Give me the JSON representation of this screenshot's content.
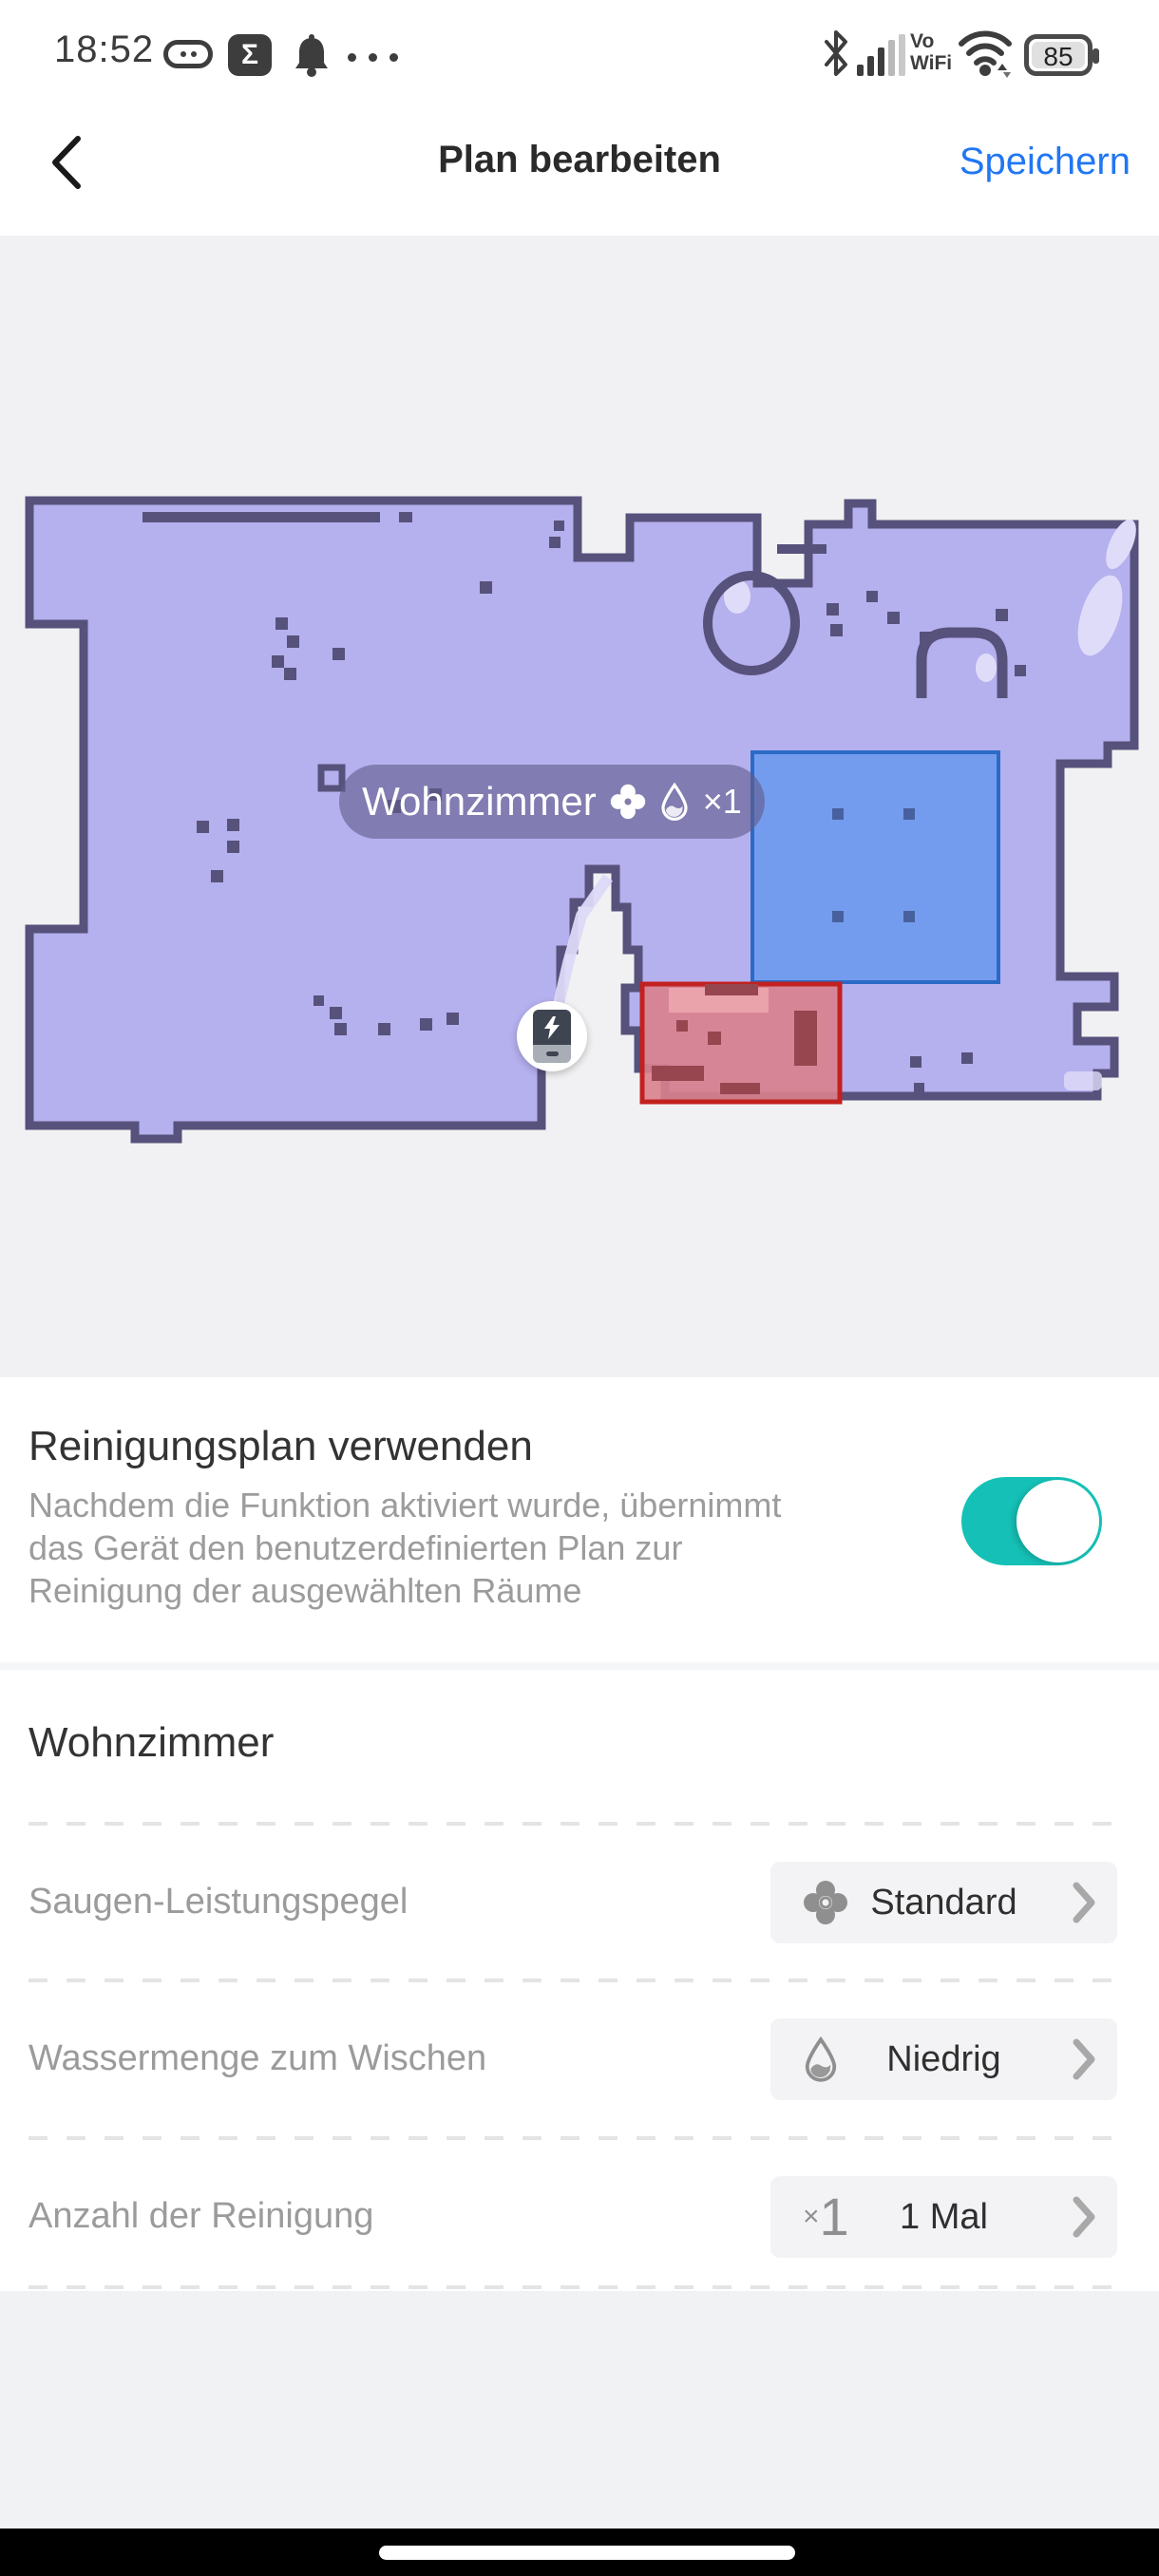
{
  "status_bar": {
    "time": "18:52",
    "sigma_glyph": "Σ",
    "vo_line1": "Vo",
    "vo_line2": "WiFi",
    "battery_percent": "85"
  },
  "header": {
    "title": "Plan bearbeiten",
    "save_label": "Speichern"
  },
  "map": {
    "pill": {
      "room_name": "Wohnzimmer",
      "count": "×1"
    }
  },
  "toggle_section": {
    "title": "Reinigungsplan verwenden",
    "description": "Nachdem die Funktion aktiviert wurde, übernimmt das Gerät den benutzerdefinierten Plan zur Reinigung der ausgewählten Räume",
    "state": "on"
  },
  "room_section": {
    "title": "Wohnzimmer",
    "rows": [
      {
        "label": "Saugen-Leistungspegel",
        "value": "Standard",
        "icon": "fan-icon"
      },
      {
        "label": "Wassermenge zum Wischen",
        "value": "Niedrig",
        "icon": "water-drop-icon"
      },
      {
        "label": "Anzahl der Reinigung",
        "value": "1 Mal",
        "icon": "times-one-icon",
        "icon_x": "×",
        "icon_num": "1"
      }
    ]
  },
  "colors": {
    "accent_blue": "#2176f3",
    "toggle_on_teal": "#15c1b6",
    "map_floor": "#b5b0ee",
    "map_wall": "#56527b",
    "zone_blue_border": "#2b6ac6",
    "zone_blue_fill": "#5b94ee",
    "nogo_red_border": "#c2211f",
    "nogo_red_fill": "#d9818d"
  }
}
